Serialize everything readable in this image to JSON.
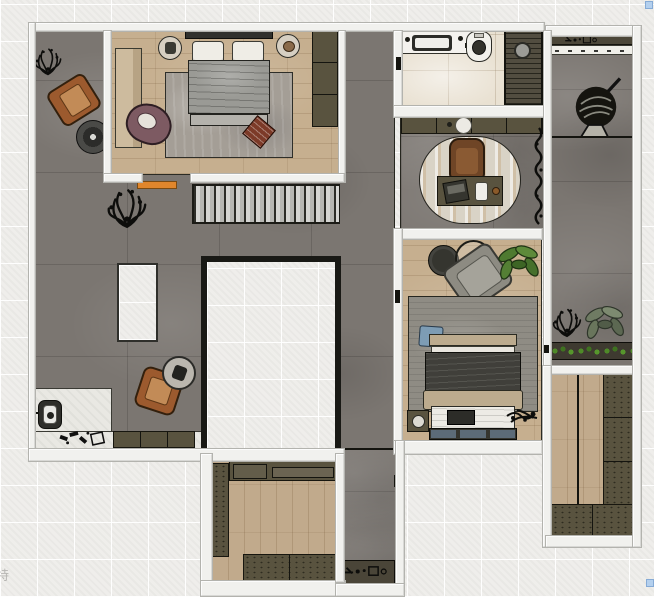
{
  "watermark": {
    "text": "特"
  },
  "ui": {
    "selection_handle_count": 2
  },
  "colors": {
    "bg": "#efeeeb",
    "wall": "#f1f1ee",
    "concrete": "#7b7671",
    "wood": "#c6af8f",
    "wood2": "#c1aa8c",
    "tile": "#e9e1d2",
    "marble": "#e9e8e3",
    "olive": "#59533f",
    "olive_dark": "#4a4537",
    "rug_gray": "#a49e96",
    "rug2_gray": "#8f8c84",
    "stairs_gray": "#c9c9c6",
    "accent_orange": "#e0862c",
    "leather_brown": "#9c5a2e",
    "mauve": "#7d5a62",
    "ottoman_red": "#7c3a28",
    "duvet_gray": "#9a9a95",
    "duvet_dark": "#403f3a",
    "blanket_tan": "#bcab8e",
    "pillow_blue": "#7d9cb4",
    "bench_blue": "#5c6b78",
    "chair_gray": "#8d8b82",
    "desk_brown": "#6f4526",
    "plant_green": "#4e7a30",
    "planter_green": "#4e8a28",
    "handle_blue": "#b4d0ee"
  }
}
